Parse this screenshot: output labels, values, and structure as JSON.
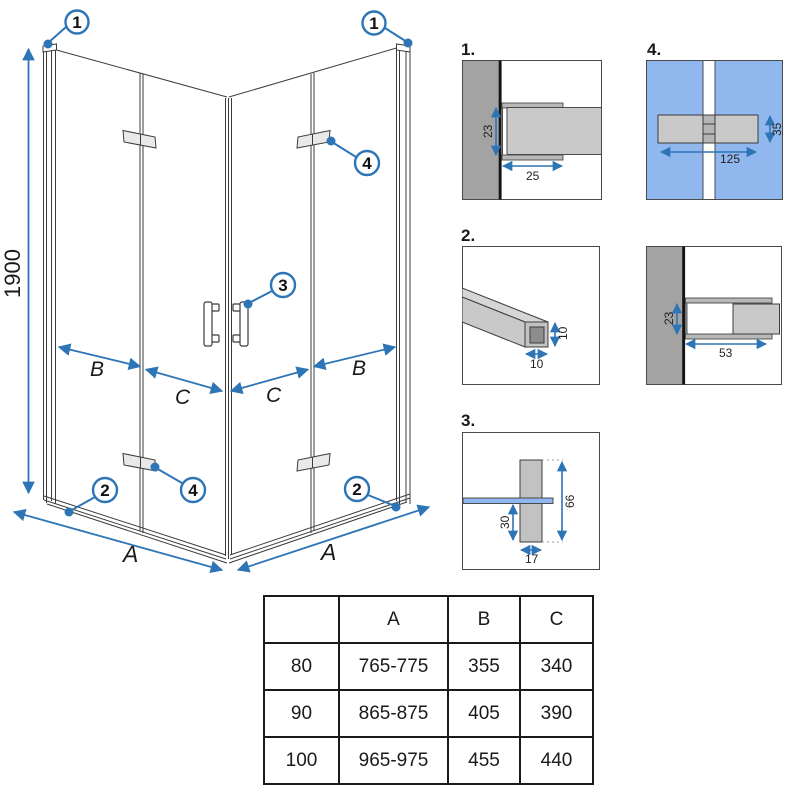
{
  "colors": {
    "accent": "#2e75b6",
    "glass_blue": "#90b8ee",
    "wall_gray": "#a3a3a3",
    "metal_gray": "#c9c9c9"
  },
  "drawing": {
    "height_dim": "1900",
    "width_dim": "A",
    "fixed_panel_dim": "B",
    "door_dim": "C",
    "callout_wall_profile": "1",
    "callout_bottom_rail": "2",
    "callout_handle": "3",
    "callout_hinge": "4"
  },
  "details": {
    "d1": {
      "label": "1.",
      "dim_depth": "23",
      "dim_width": "25"
    },
    "d2": {
      "label": "2.",
      "dim_height": "10",
      "dim_width": "10"
    },
    "d3": {
      "label": "3.",
      "dim_total_height": "66",
      "dim_below_glass": "30",
      "dim_width": "17"
    },
    "d4": {
      "label": "4.",
      "dim_height": "35",
      "dim_width": "125"
    },
    "d5": {
      "dim_depth": "23",
      "dim_width": "53"
    }
  },
  "table": {
    "headers": [
      "",
      "A",
      "B",
      "C"
    ],
    "rows": [
      [
        "80",
        "765-775",
        "355",
        "340"
      ],
      [
        "90",
        "865-875",
        "405",
        "390"
      ],
      [
        "100",
        "965-975",
        "455",
        "440"
      ]
    ]
  }
}
